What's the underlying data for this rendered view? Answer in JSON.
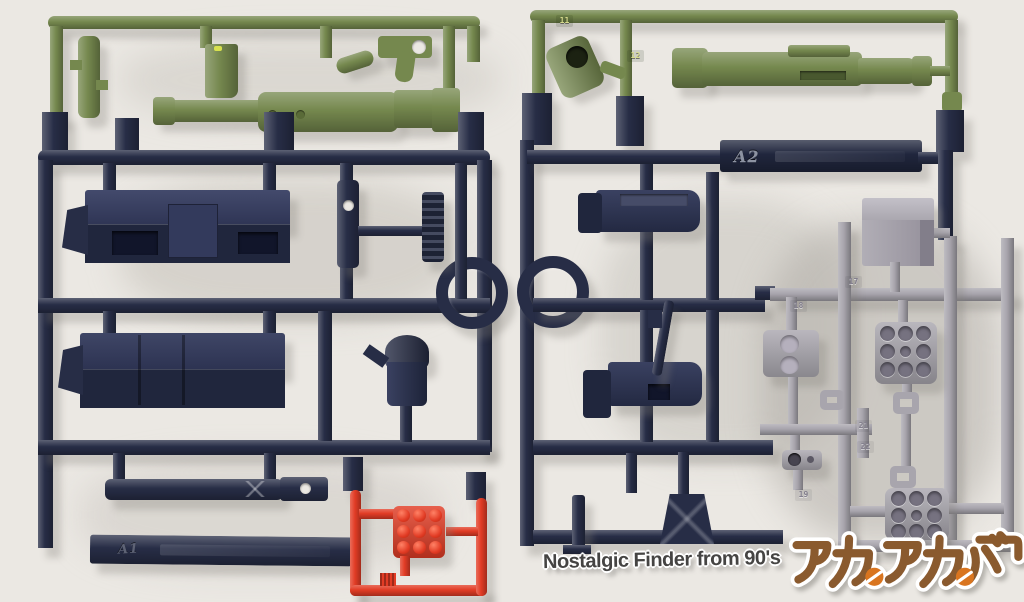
{
  "scene": {
    "subject": "Photograph of two plastic model-kit part runners (sprues) laid side by side on a white background: dark navy frames carrying olive-green weapon parts on top, a light-gray detail-part sub-runner on the right, and a red missile-pod part at bottom center"
  },
  "colors": {
    "background": "#ebe8e3",
    "navy": "#272d46",
    "olive": "#75884e",
    "gray": "#a8a5ad",
    "red": "#e23c25",
    "logobrown": "#8a5a2e",
    "logoorange": "#d9751f",
    "watermarktext": "#454443"
  },
  "runner_left": {
    "tag_label": "A1"
  },
  "runner_right": {
    "tag_label": "A2",
    "part_numbers": {
      "n11": "11",
      "n12": "12",
      "n17": "17",
      "n18": "18",
      "n19": "19",
      "n21": "21",
      "n22": "22"
    }
  },
  "watermark": {
    "latin": "Nostalgic Finder from 90's",
    "katakana": "アカ。アカ。バー"
  }
}
